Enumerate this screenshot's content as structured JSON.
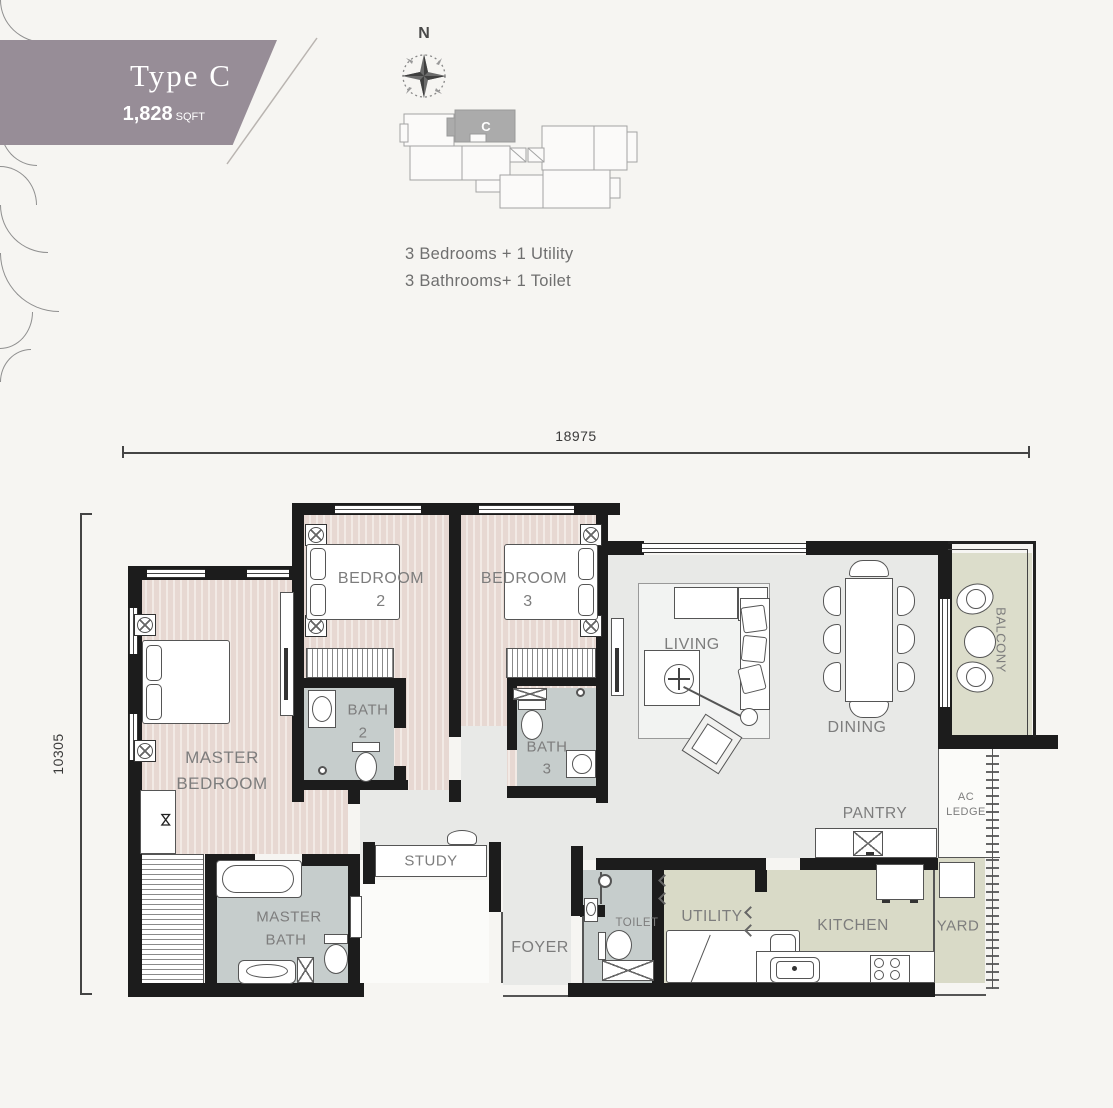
{
  "banner": {
    "title": "Type C",
    "area": "1,828",
    "area_unit": "SQFT",
    "color": "#978d97"
  },
  "compass": {
    "north": "N"
  },
  "key_plan": {
    "unit": "C"
  },
  "summary": {
    "line1": "3 Bedrooms + 1 Utility",
    "line2": "3 Bathrooms+ 1 Toilet"
  },
  "dimensions": {
    "width": "18975",
    "height": "10305"
  },
  "rooms": {
    "master_bedroom": {
      "line1": "MASTER",
      "line2": "BEDROOM"
    },
    "bedroom2": {
      "line1": "BEDROOM",
      "line2": "2"
    },
    "bedroom3": {
      "line1": "BEDROOM",
      "line2": "3"
    },
    "bath2": {
      "line1": "BATH",
      "line2": "2"
    },
    "bath3": {
      "line1": "BATH",
      "line2": "3"
    },
    "master_bath": {
      "line1": "MASTER",
      "line2": "BATH"
    },
    "study": {
      "label": "STUDY"
    },
    "foyer": {
      "label": "FOYER"
    },
    "toilet": {
      "label": "TOILET"
    },
    "utility": {
      "label": "UTILITY"
    },
    "kitchen": {
      "label": "KITCHEN"
    },
    "yard": {
      "label": "YARD"
    },
    "pantry": {
      "label": "PANTRY"
    },
    "ac_ledge": {
      "line1": "AC",
      "line2": "LEDGE"
    },
    "living": {
      "label": "LIVING"
    },
    "dining": {
      "label": "DINING"
    },
    "balcony": {
      "label": "BALCONY"
    }
  },
  "colors": {
    "wall": "#1c1c1c",
    "bedroom_floor": "#e9dbd4",
    "common_floor": "#e8e9e7",
    "bath_floor": "#c6cdcc",
    "service_floor": "#d9dac7",
    "balcony_floor": "#dcddcb",
    "label_text": "#7d7d7d"
  }
}
